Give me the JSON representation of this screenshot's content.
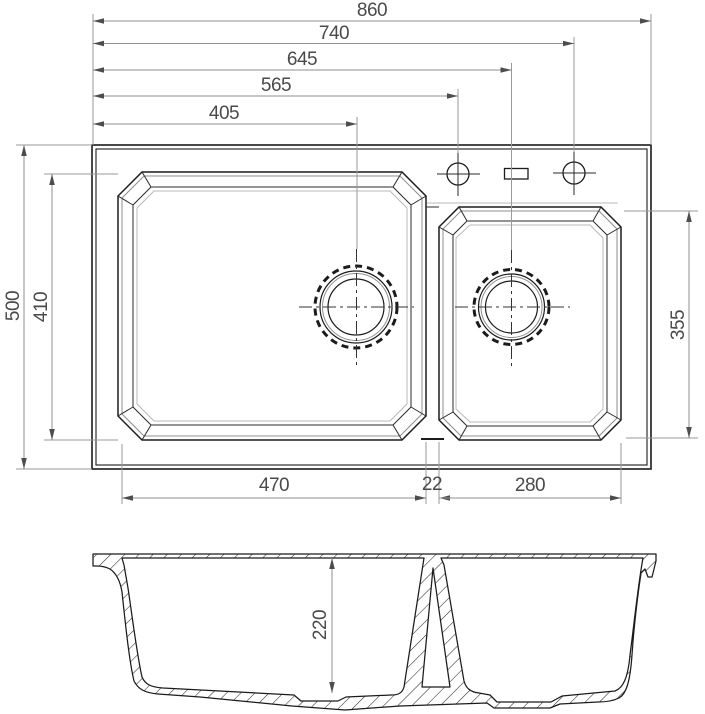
{
  "meta": {
    "title": "Double bowl kitchen sink dimensional drawing",
    "colors": {
      "outline": "#1b1b1b",
      "dimension_lines": "#8f8f8f",
      "dimension_text": "#4a4a4a",
      "background": "#ffffff"
    }
  },
  "dims": {
    "top": [
      {
        "name": "overall-width",
        "value": "860"
      },
      {
        "name": "right-faucet-hole-offset",
        "value": "740"
      },
      {
        "name": "small-bowl-drain-offset",
        "value": "645"
      },
      {
        "name": "left-faucet-hole-offset",
        "value": "565"
      },
      {
        "name": "main-bowl-drain-offset",
        "value": "405"
      }
    ],
    "left": [
      {
        "name": "overall-depth",
        "value": "500"
      },
      {
        "name": "main-bowl-depth",
        "value": "410"
      }
    ],
    "right": [
      {
        "name": "small-bowl-depth",
        "value": "355"
      }
    ],
    "bottom": [
      {
        "name": "main-bowl-width",
        "value": "470"
      },
      {
        "name": "divider-width",
        "value": "22"
      },
      {
        "name": "small-bowl-width",
        "value": "280"
      }
    ],
    "section": [
      {
        "name": "bowl-inner-height",
        "value": "220"
      }
    ]
  }
}
